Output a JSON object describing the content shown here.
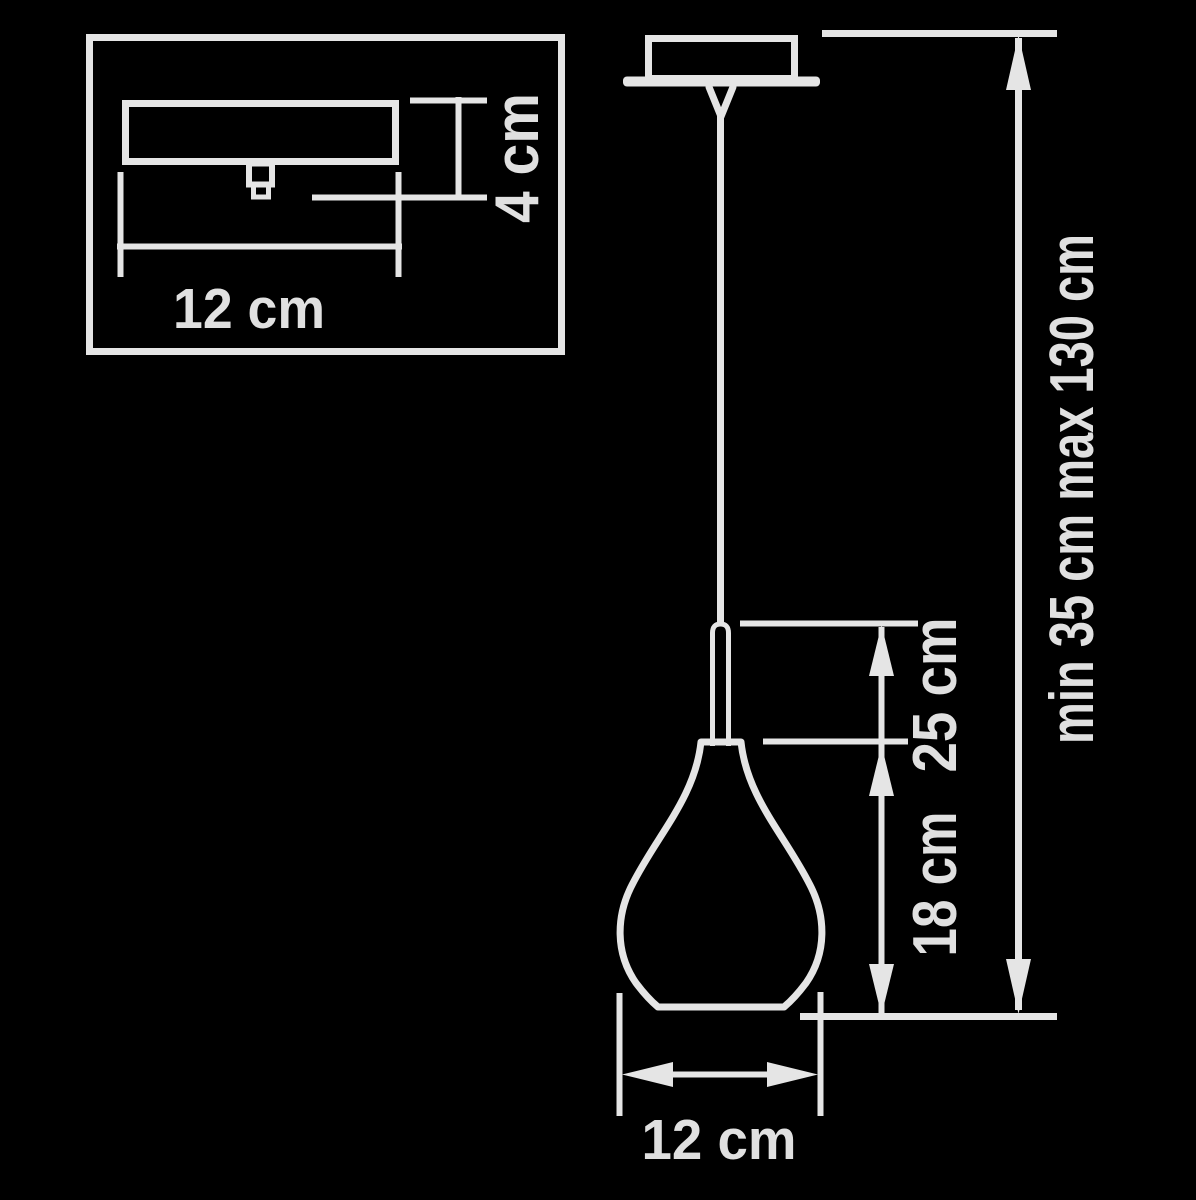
{
  "title": "Pendant lamp technical dimension diagram",
  "colors": {
    "background": "#000000",
    "line": "#e5e5e5",
    "text": "#e0e0e0"
  },
  "inset": {
    "description": "canopy side view detail box",
    "width_label": "12 cm",
    "height_label": "4 cm"
  },
  "pendant": {
    "description": "teardrop pendant lamp front view",
    "fixture_height_label": "25 cm",
    "shade_height_label": "18 cm",
    "shade_width_label": "12 cm",
    "suspension_label": "min 35 cm max 130 cm"
  }
}
